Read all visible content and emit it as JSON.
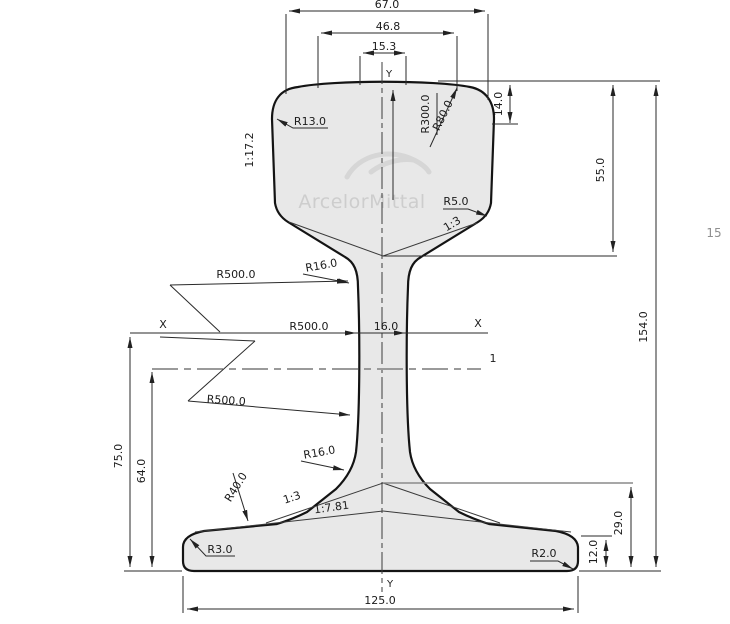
{
  "drawing": {
    "watermark": {
      "brand": "ArcelorMittal"
    },
    "page_number": "15",
    "axes": {
      "x_left": "X",
      "x_right": "X",
      "y_top": "Y",
      "y_bottom": "Y",
      "ref_line": "1"
    },
    "dims": {
      "head_width": "67.0",
      "head_mid_width": "46.8",
      "crown_flat_width": "15.3",
      "corner_drop": "14.0",
      "head_depth": "55.0",
      "total_height": "154.0",
      "web_thickness": "16.0",
      "x_axis_height": "75.0",
      "ref_line_height": "64.0",
      "foot_rise": "29.0",
      "foot_edge_height": "12.0",
      "base_width": "125.0"
    },
    "radii": {
      "head_corner": "R13.0",
      "crown": "R300.0",
      "shoulder": "R80.0",
      "head_underside": "R5.0",
      "web_top_fillet": "R16.0",
      "web_face_upper": "R500.0",
      "web_face_mid": "R500.0",
      "web_face_lower": "R500.0",
      "web_bottom_fillet": "R16.0",
      "foot_fillet": "R40.0",
      "foot_left_corner": "R3.0",
      "foot_right_corner": "R2.0"
    },
    "slopes": {
      "head_side": "1:17.2",
      "head_underside": "1:3",
      "foot_inner": "1:3",
      "foot_surface": "1:7.81"
    }
  }
}
